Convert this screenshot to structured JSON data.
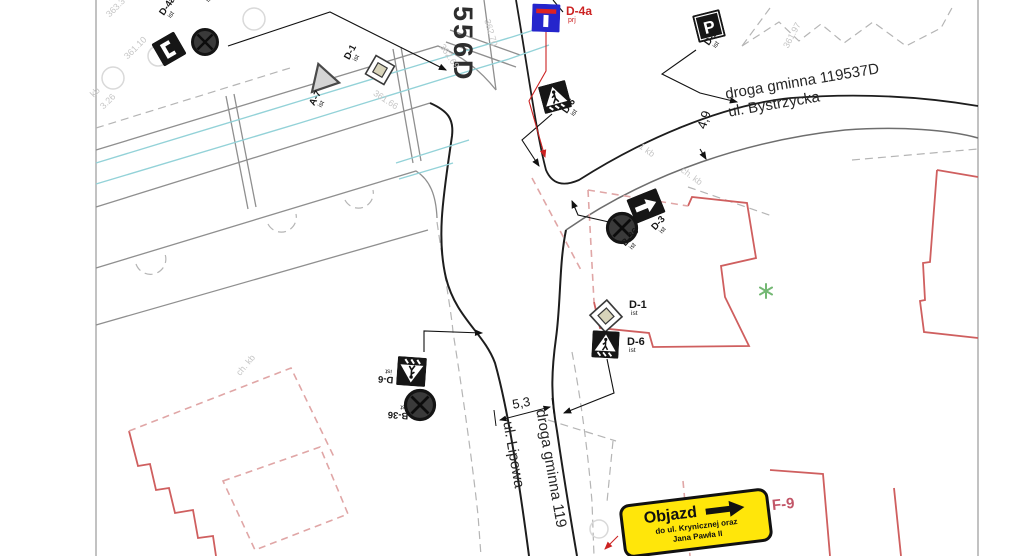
{
  "map": {
    "labels": {
      "road_top_vertical": "556D",
      "bystrzycka_ref": "droga gminna 119537D",
      "bystrzycka_name": "ul. Bystrzycka",
      "lipowa_ref": "droga gminna 119",
      "lipowa_name": "ul. Lipowa"
    },
    "dimensions": {
      "bystrzycka_width": "4,9",
      "lipowa_width": "5,3"
    },
    "signs": [
      {
        "code": "D-4a",
        "status": "ist"
      },
      {
        "code": "B-36",
        "status": "ist"
      },
      {
        "code": "A-7",
        "status": "ist"
      },
      {
        "code": "D-1",
        "status": "ist"
      },
      {
        "code": "D-4a",
        "status": "prj"
      },
      {
        "code": "D-6",
        "status": "ist"
      },
      {
        "code": "D-18",
        "status": "ist"
      },
      {
        "code": "D-3",
        "status": "ist"
      },
      {
        "code": "B-36",
        "status": "ist"
      },
      {
        "code": "D-1",
        "status": "ist"
      },
      {
        "code": "D-6",
        "status": "ist"
      },
      {
        "code": "D-6",
        "status": "ist"
      },
      {
        "code": "B-36",
        "status": "ist"
      }
    ],
    "detour_sign": {
      "code": "F-9",
      "title": "Objazd",
      "line1": "do ul. Krynicznej oraz",
      "line2": "Jana Pawła II"
    },
    "icon_letters": {
      "parking": "P"
    },
    "annotations": [
      {
        "text": "kb"
      },
      {
        "text": "363.3"
      },
      {
        "text": "361.10"
      },
      {
        "text": "3.26"
      },
      {
        "text": "362.70"
      },
      {
        "text": "362.69"
      },
      {
        "text": "361.66"
      },
      {
        "text": "361.97"
      },
      {
        "text": "1 kb"
      },
      {
        "text": "ch. kb"
      },
      {
        "text": "ch. kb"
      }
    ],
    "colors": {
      "proposed_red": "#cc2222",
      "detour_yellow": "#ffe60a",
      "building_red": "#cf5f5f",
      "building_dashed_pink": "#e0a6a6",
      "utility_cyan": "#93d2d8",
      "tree_green": "#74b874",
      "sign_black": "#161616"
    }
  }
}
